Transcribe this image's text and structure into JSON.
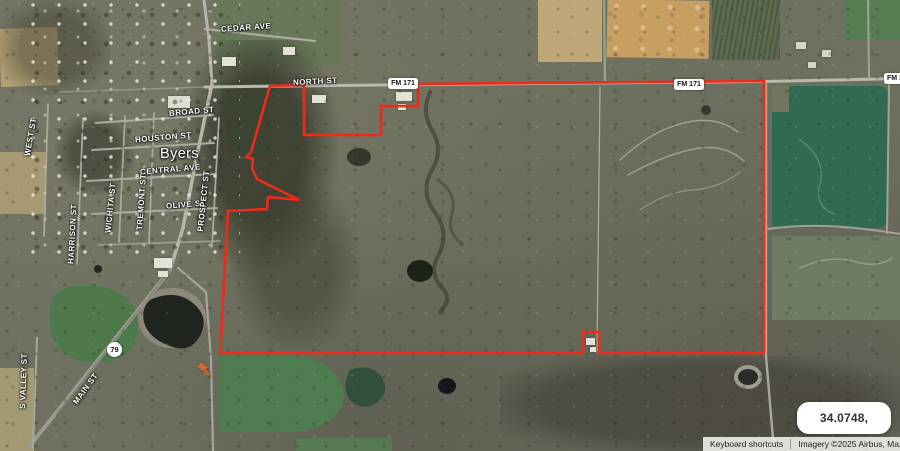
{
  "town": {
    "name": "Byers"
  },
  "streets": {
    "cedar": "CEDAR AVE",
    "north": "NORTH ST",
    "broad": "BROAD ST",
    "houston": "HOUSTON ST",
    "central": "CENTRAL AVE",
    "olive": "OLIVE ST",
    "prospect": "PROSPECT ST",
    "tremont": "TREMONT ST",
    "wichita": "WICHITA ST",
    "west": "WEST ST",
    "harrison": "HARRISON ST",
    "svalley": "S VALLEY ST",
    "main": "MAIN ST"
  },
  "shields": {
    "fm171_west": "FM 171",
    "fm171_east": "FM 171",
    "fm171_edge": "FM 171",
    "hwy79": "79"
  },
  "overlay": {
    "coordinates": "34.0748, -98.1624"
  },
  "attribution": {
    "keyboard_shortcuts": "Keyboard shortcuts",
    "imagery_credit": "Imagery ©2025 Airbus, Maxar Technol"
  },
  "colors": {
    "boundary_red": "#f02a1b",
    "field_dark_green": "#2f6b53",
    "shield_background": "#ffffff"
  }
}
